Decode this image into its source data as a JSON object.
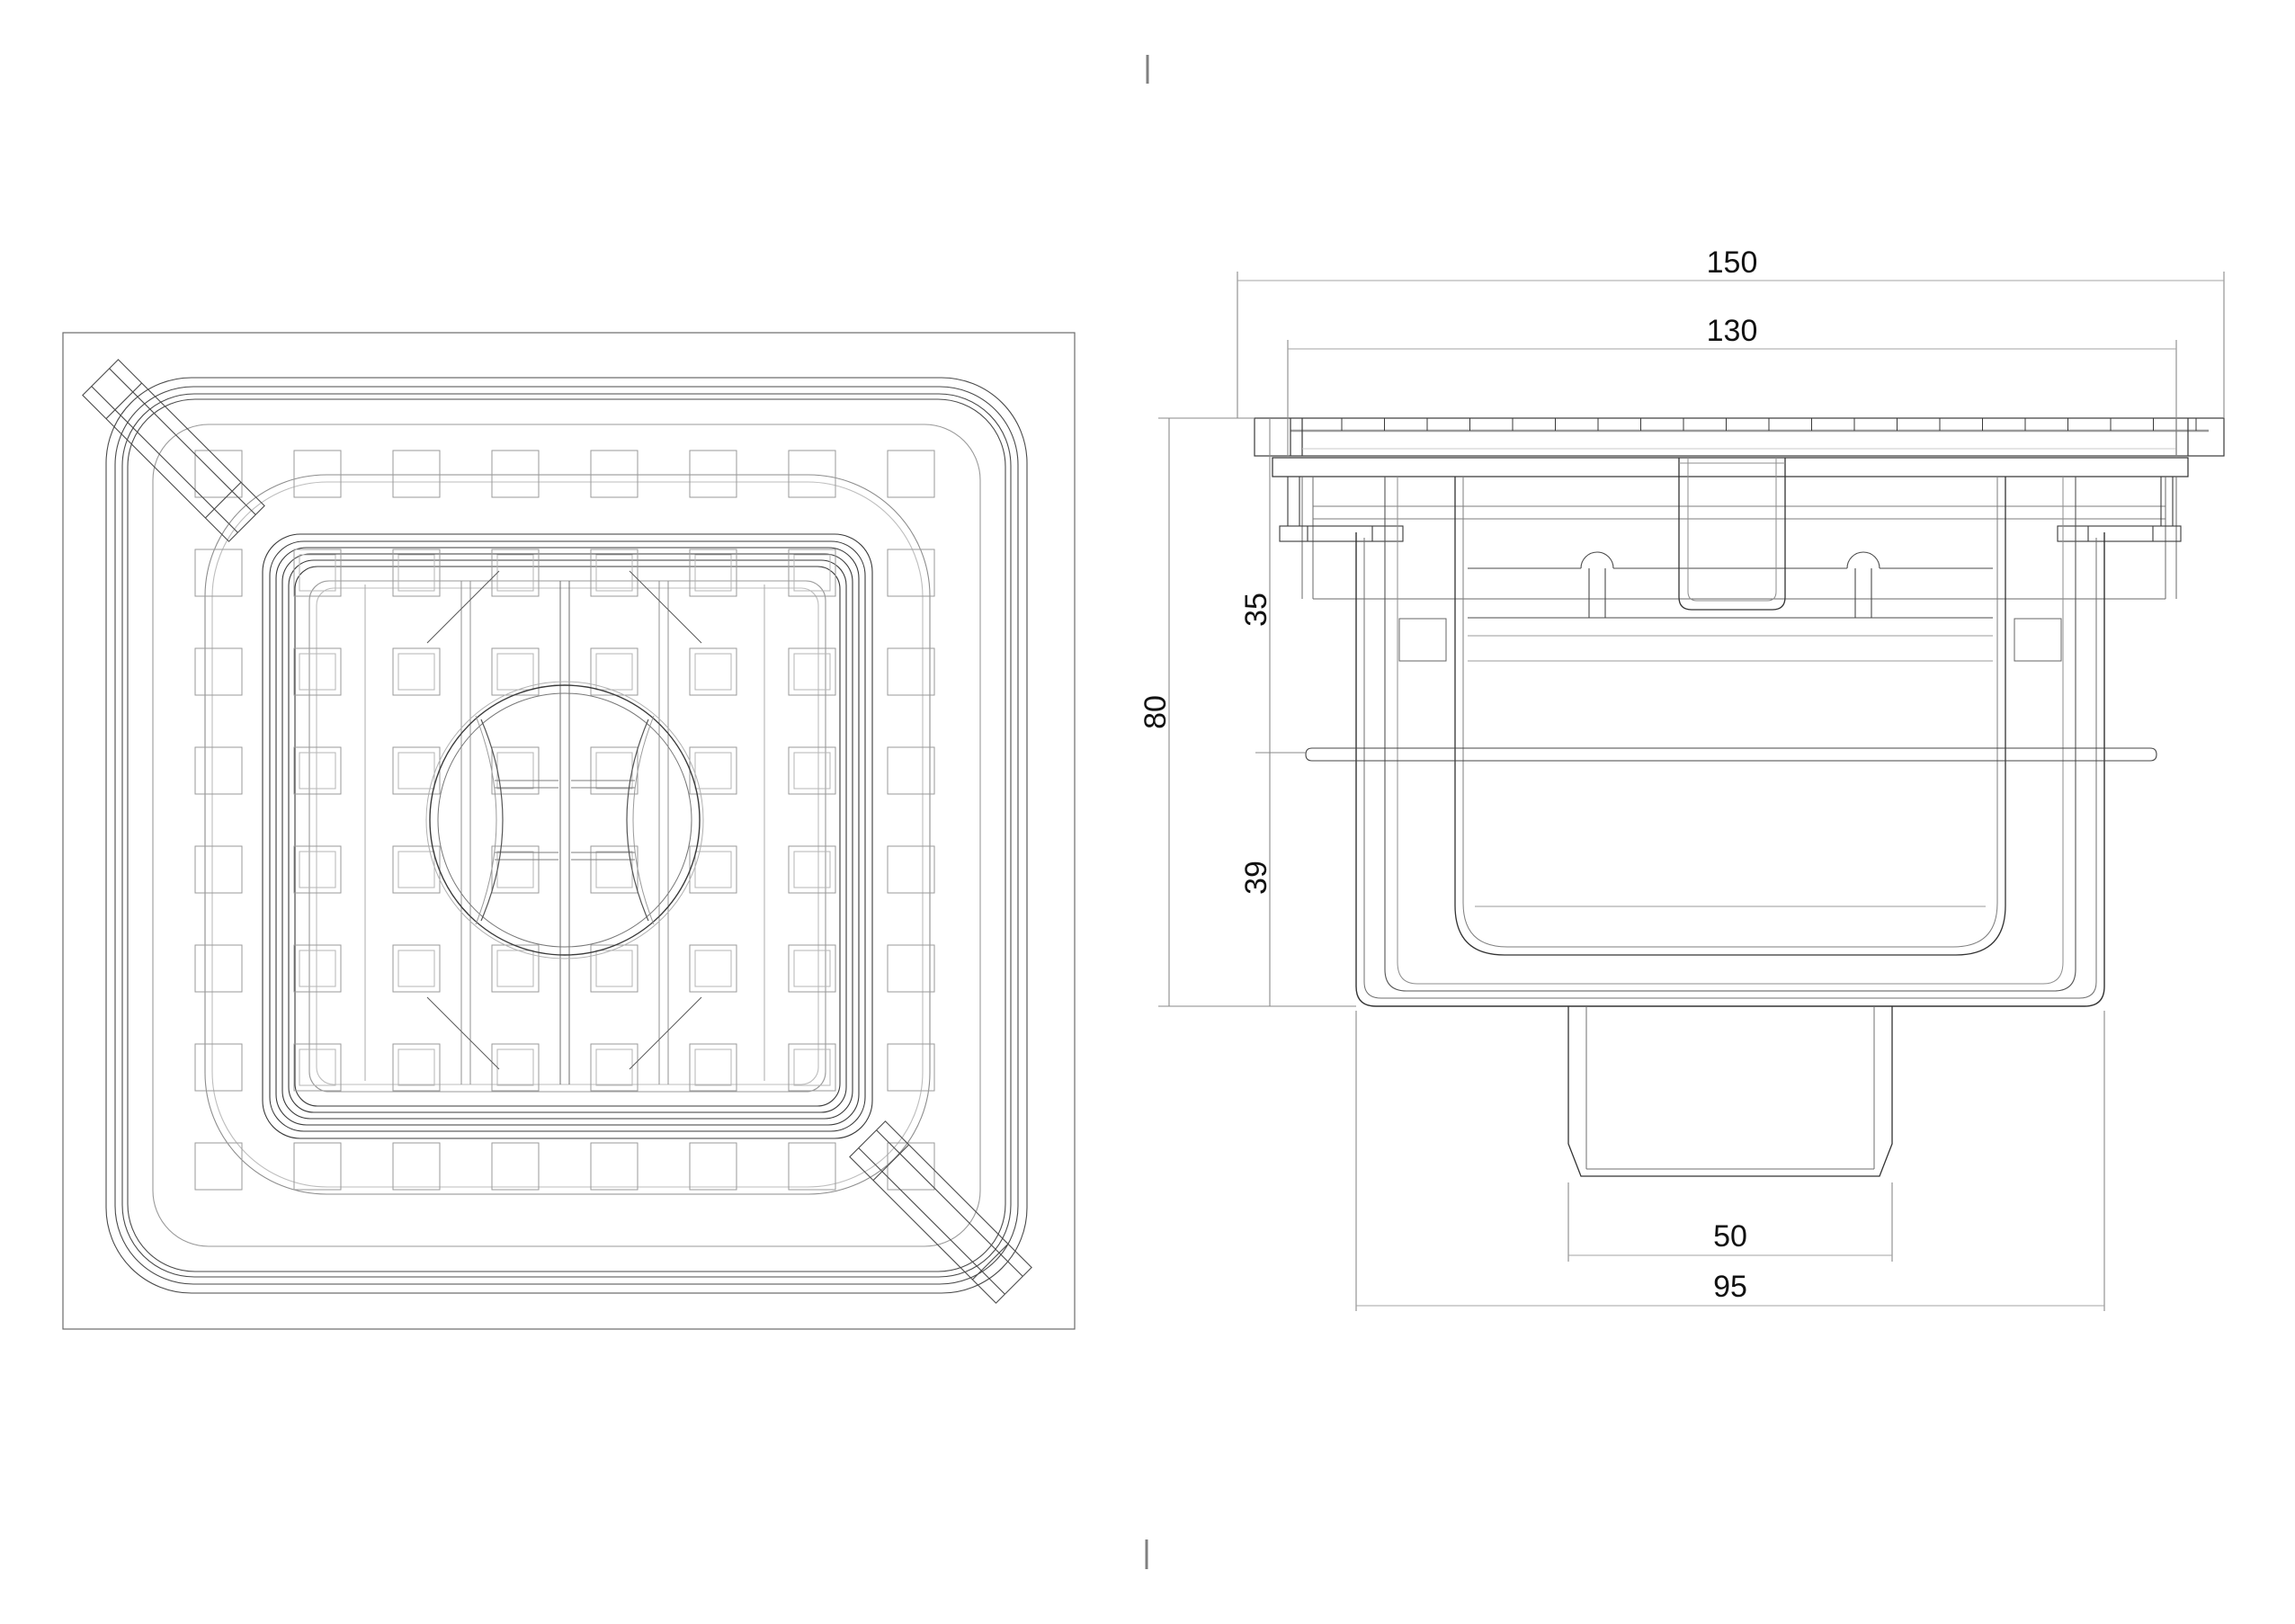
{
  "colors": {
    "background": "#ffffff",
    "line_dark": "#3a3a3a",
    "line_medium": "#777777",
    "line_light": "#aaaaaa",
    "dimension_line": "#a3a3a3",
    "extension_line": "#8a8a8a",
    "label_text": "#111111",
    "registration_mark": "#808080"
  },
  "dimensions": {
    "overall_width": "150",
    "grate_width": "130",
    "overall_height": "80",
    "upper_height": "35",
    "lower_height": "39",
    "outlet_width": "50",
    "body_width": "95"
  }
}
